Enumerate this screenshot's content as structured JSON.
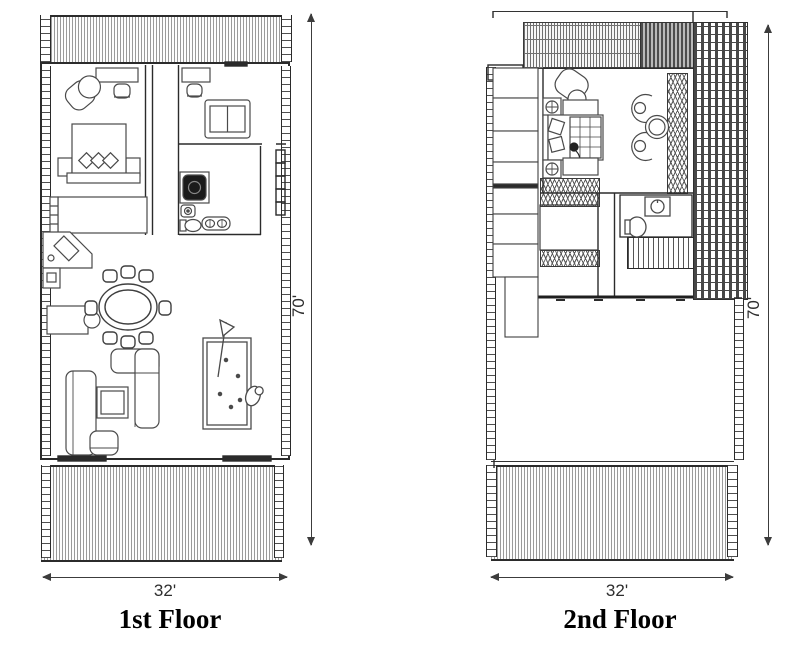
{
  "colors": {
    "wall": "#2b2b2b",
    "furniture_stroke": "#4a4a4a",
    "hatch": "#9a9a9a",
    "lattice": "#474747",
    "dimension": "#3c3c3c",
    "title_text": "#000000",
    "background": "#ffffff"
  },
  "plans": [
    {
      "title": "1st Floor",
      "width_label": "32'",
      "height_label": "70'",
      "symbols": [
        "deck-top",
        "deck-bottom",
        "bed",
        "pillows",
        "nightstands",
        "wardrobe",
        "closet",
        "desk",
        "office-chair",
        "lounge-chair",
        "loveseat",
        "shower",
        "toilet",
        "bidet",
        "double-sink",
        "corner-kitchen-sink",
        "appliance",
        "kitchen-island",
        "dining-table",
        "dining-chairs",
        "sectional-sofa",
        "sofa",
        "coffee-table",
        "pool-table",
        "cue",
        "stool"
      ]
    },
    {
      "title": "2nd Floor",
      "width_label": "32'",
      "height_label": "70'",
      "symbols": [
        "roof-slats",
        "pergola-lattice",
        "deck-bottom",
        "bed",
        "pillows",
        "person",
        "nightstands",
        "benches",
        "lounge-chair",
        "armchairs",
        "round-table",
        "closet-cabinets",
        "hanging-wardrobe",
        "washbasin",
        "toilet",
        "staircase",
        "open-void"
      ]
    }
  ]
}
